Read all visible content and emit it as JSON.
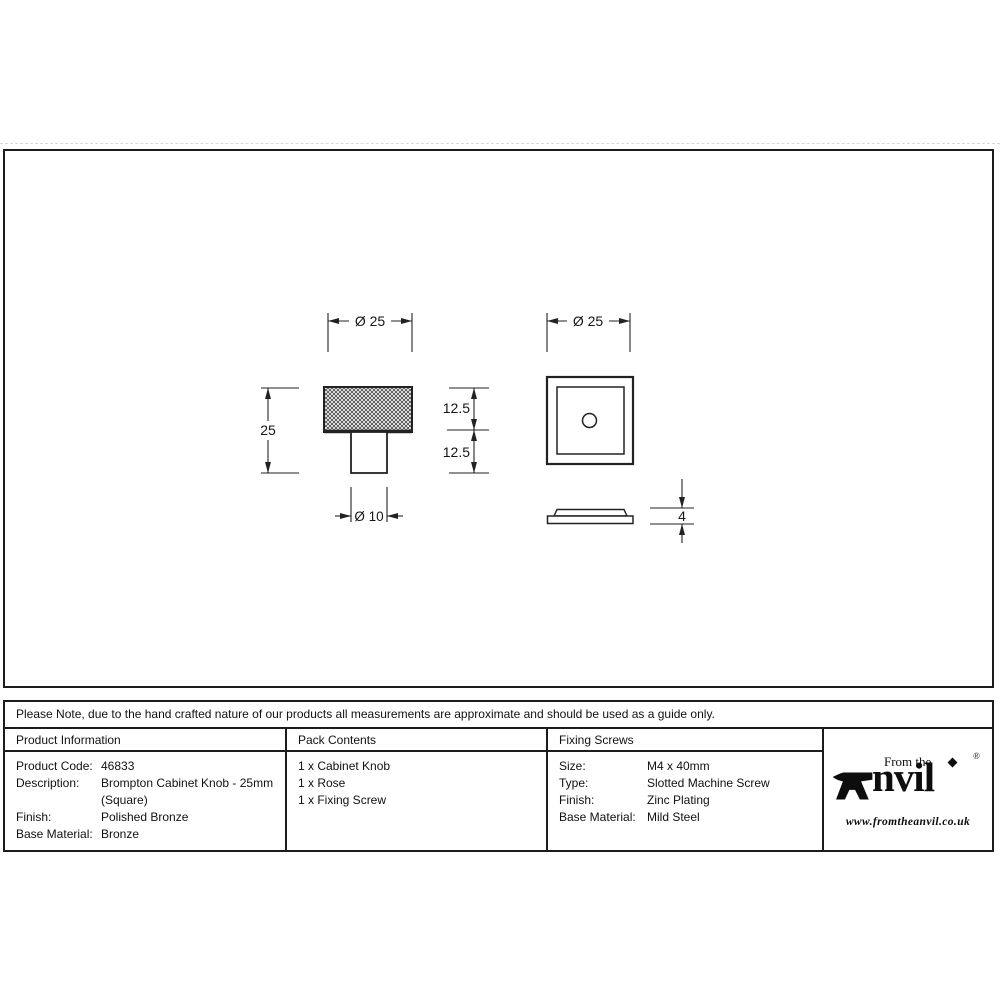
{
  "note": "Please Note, due to the hand crafted nature of our products all measurements are approximate and should be used as a guide only.",
  "table": {
    "product_information": {
      "header": "Product Information",
      "rows": [
        {
          "label": "Product Code:",
          "value": "46833"
        },
        {
          "label": "Description:",
          "value": "Brompton Cabinet Knob - 25mm (Square)"
        },
        {
          "label": "Finish:",
          "value": "Polished Bronze"
        },
        {
          "label": "Base Material:",
          "value": "Bronze"
        }
      ]
    },
    "pack_contents": {
      "header": "Pack Contents",
      "items": [
        "1 x Cabinet Knob",
        "1 x Rose",
        "1 x Fixing Screw"
      ]
    },
    "fixing_screws": {
      "header": "Fixing Screws",
      "rows": [
        {
          "label": "Size:",
          "value": "M4 x 40mm"
        },
        {
          "label": "Type:",
          "value": "Slotted Machine Screw"
        },
        {
          "label": "Finish:",
          "value": "Zinc Plating"
        },
        {
          "label": "Base Material:",
          "value": "Mild Steel"
        }
      ]
    }
  },
  "logo": {
    "from_the": "From the",
    "name_rest": "nvil",
    "registered": "®",
    "url": "www.fromtheanvil.co.uk"
  },
  "drawing": {
    "knob_side_view": {
      "dim_head_width": "Ø 25",
      "dim_total_height": "25",
      "dim_head_height": "12.5",
      "dim_stem_height": "12.5",
      "dim_stem_width": "Ø 10"
    },
    "rose_top_view": {
      "dim_width": "Ø 25"
    },
    "rose_side_view": {
      "dim_thickness": "4"
    }
  },
  "colors": {
    "line": "#1c1c1c",
    "background": "#ffffff"
  }
}
